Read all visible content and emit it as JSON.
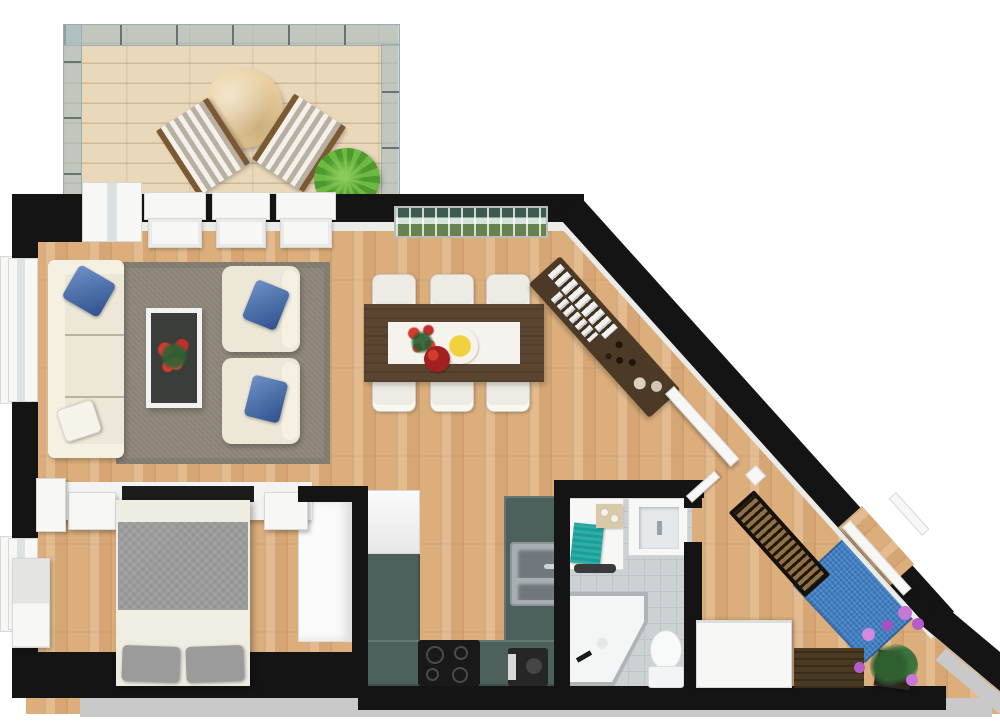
{
  "meta": {
    "title": "Apartment 3D Floor Plan (top-down view)",
    "style": "photorealistic 3d floorplan, no text labels"
  },
  "colors": {
    "exterior": "#ffffff",
    "wall": "#141414",
    "wall_face": "#ebebe8",
    "skirting": "#c9c9c9",
    "wood_floor": "#dcae7c",
    "deck_wood": "#e9d8ba",
    "glass_railing": "#a6bcc0",
    "deck_table": "#e9cf9e",
    "plant_green": "#55a232",
    "seating_cream": "#ece7d6",
    "pillow_blue": "#3e6cb4",
    "pillow_white": "#f6f4ea",
    "living_rug": "#8b8376",
    "coffee_table_glass": "#3a3d3a",
    "flower_red": "#d63a30",
    "dining_table_wood": "#5a4530",
    "table_runner": "#f4f3ee",
    "banana_yellow": "#f1d23e",
    "apple_red": "#a32020",
    "sideboard_wood": "#4c3a27",
    "radiator_wood": "#8f7148",
    "kitchen_counter": "#4d615c",
    "cooktop_black": "#191919",
    "sink_steel": "#a7adb1",
    "bathroom_tile": "#ccd1d4",
    "towel_teal": "#17a09a",
    "shower_white": "#f4f6f6",
    "duvet_gray": "#9c9c9c",
    "bed_pillow_gray": "#9b9b9b",
    "bed_sheet": "#f1eee3",
    "hall_rug_blue": "#3d7fc3",
    "bench_wood": "#4a3a24",
    "orchid_purple": "#b55cc9",
    "wardrobe_white": "#fbfbfb"
  },
  "scene": {
    "rooms": [
      {
        "name": "terrace-deck",
        "features": [
          "wood-deck",
          "glass-railing"
        ],
        "furniture": [
          "round-table",
          "two-striped-lounge-chairs",
          "potted-plant"
        ]
      },
      {
        "name": "living-room",
        "furniture": [
          "three-seat-sofa",
          "two-armchairs",
          "glass-coffee-table-with-red-flowers",
          "gray-area-rug",
          "panoramic-wall-picture",
          "sideboard-with-books"
        ]
      },
      {
        "name": "dining-area",
        "furniture": [
          "dark-wood-dining-table",
          "six-white-chairs",
          "red-flower-bouquet",
          "banana-plate",
          "apple-bowl"
        ]
      },
      {
        "name": "bedroom",
        "furniture": [
          "double-bed-gray-duvet",
          "two-gray-pillows",
          "floating-shelves",
          "wardrobe",
          "window-dresser"
        ]
      },
      {
        "name": "kitchen",
        "furniture": [
          "u-shaped-teal-counter",
          "tall-white-cabinet",
          "double-steel-sink",
          "black-cooktop",
          "coffee-machine"
        ]
      },
      {
        "name": "bathroom",
        "furniture": [
          "vanity-with-teal-towel",
          "washbasin",
          "corner-shower",
          "toilet"
        ]
      },
      {
        "name": "hallway",
        "furniture": [
          "wall-radiator",
          "blue-rug",
          "white-sideboard",
          "wood-bench",
          "orchid-plant",
          "entry-door"
        ]
      }
    ]
  }
}
